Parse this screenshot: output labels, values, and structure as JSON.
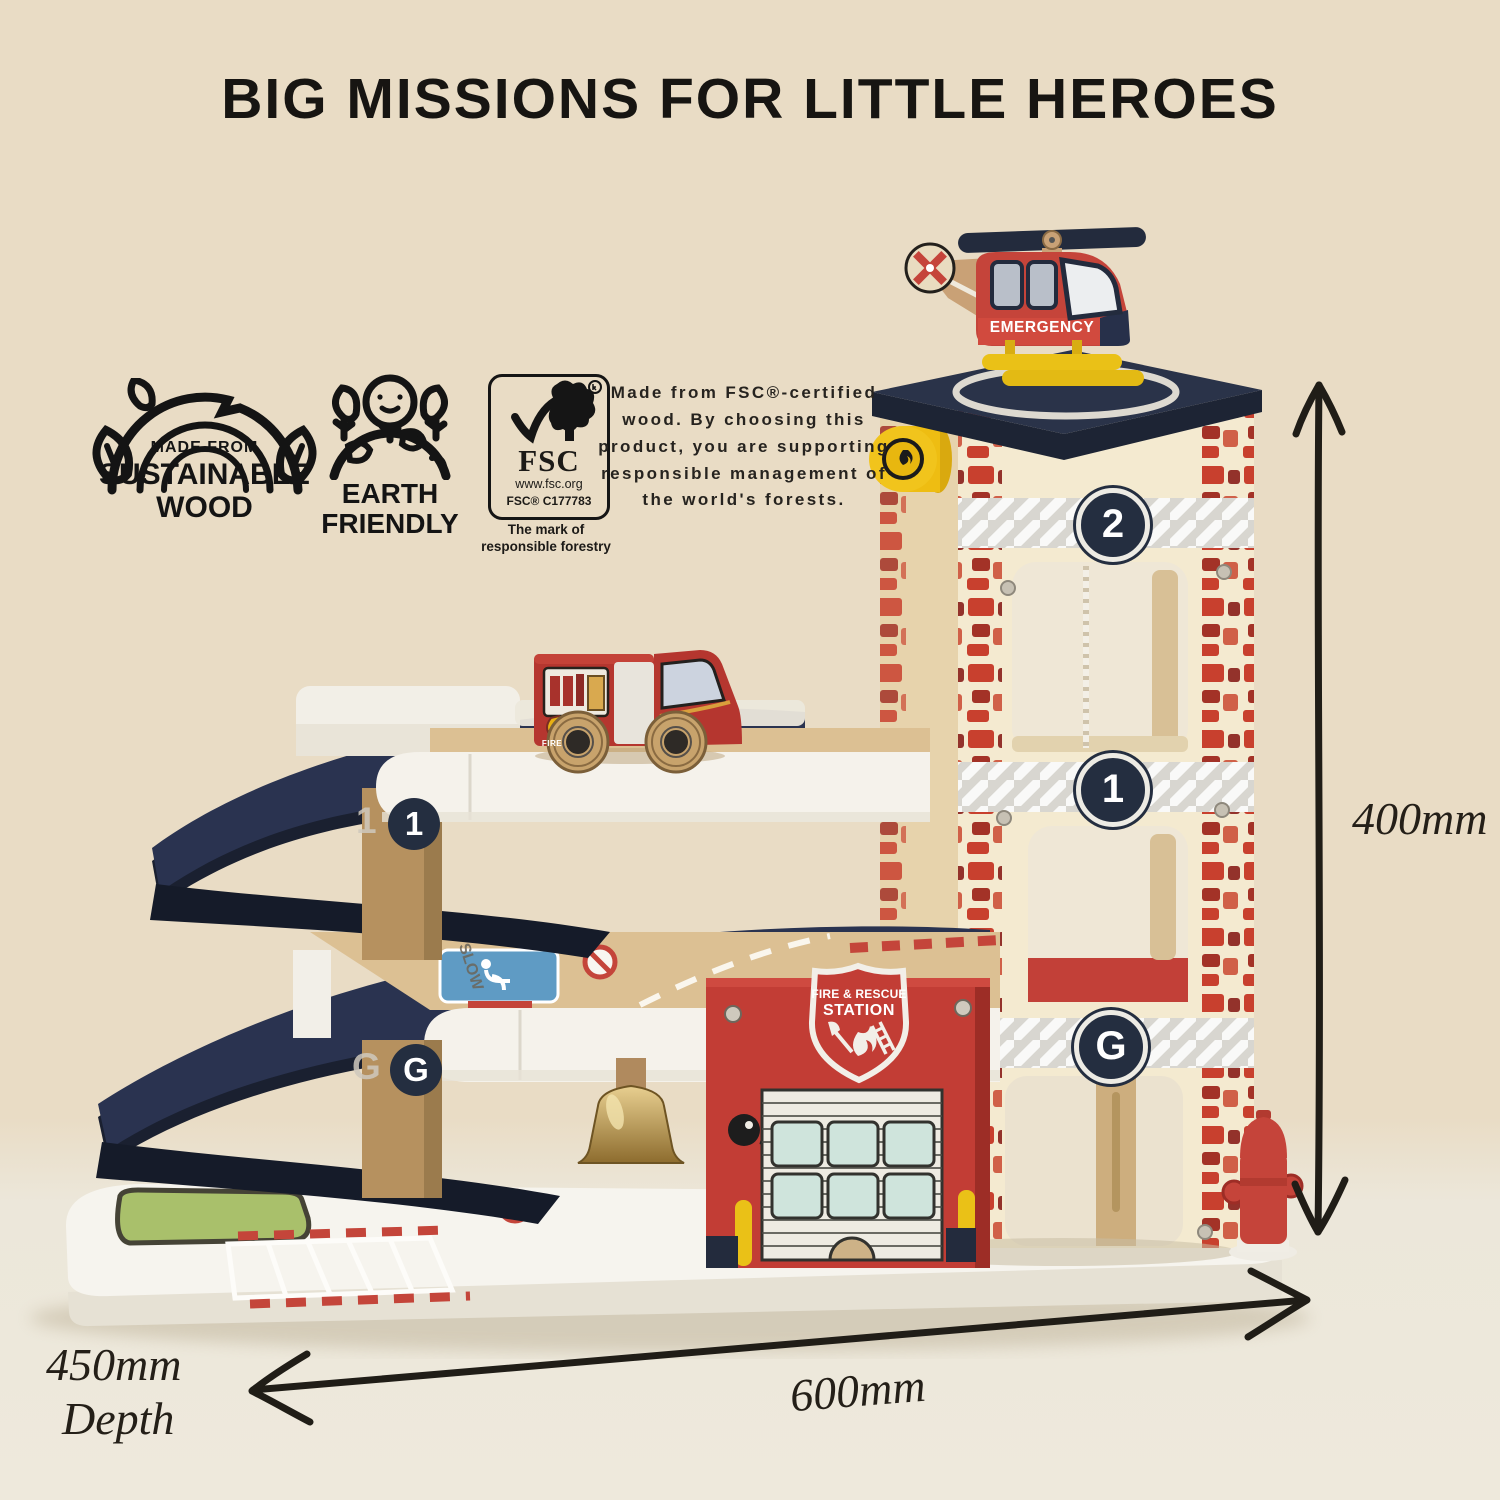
{
  "title": "BIG MISSIONS FOR LITTLE HEROES",
  "badges": {
    "sustainable_wood": {
      "top": "MADE FROM",
      "middle": "SUSTAINABLE",
      "bottom": "WOOD"
    },
    "earth_friendly": {
      "line1": "EARTH",
      "line2": "FRIENDLY"
    },
    "fsc": {
      "acronym": "FSC",
      "website": "www.fsc.org",
      "license": "FSC® C177783",
      "tagline1": "The mark of",
      "tagline2": "responsible forestry"
    }
  },
  "fsc_note": "Made from FSC®-certified wood. By choosing this product, you are supporting responsible management of the world's forests.",
  "dimensions": {
    "height": "400mm",
    "width": "600mm",
    "depth": "450mm",
    "depth_label": "Depth"
  },
  "toy": {
    "helicopter_label": "EMERGENCY",
    "tower_floors": {
      "second": "2",
      "first": "1",
      "ground": "G"
    },
    "pillar_floors": {
      "first": "1",
      "ground": "G"
    },
    "shield": {
      "line1": "FIRE & RESCUE",
      "line2": "STATION"
    },
    "truck_label": "FIRE",
    "road_marking": "SLOW"
  },
  "colors": {
    "bg": "#e9dcc5",
    "ink": "#1c1a17",
    "red": "#c23d35",
    "navy": "#27304a",
    "yellow": "#eac117",
    "wood": "#b6915f",
    "cream": "#f4ead0",
    "deck": "#f5f2eb",
    "mint": "#cfe4dc",
    "grass": "#a9c06b"
  }
}
